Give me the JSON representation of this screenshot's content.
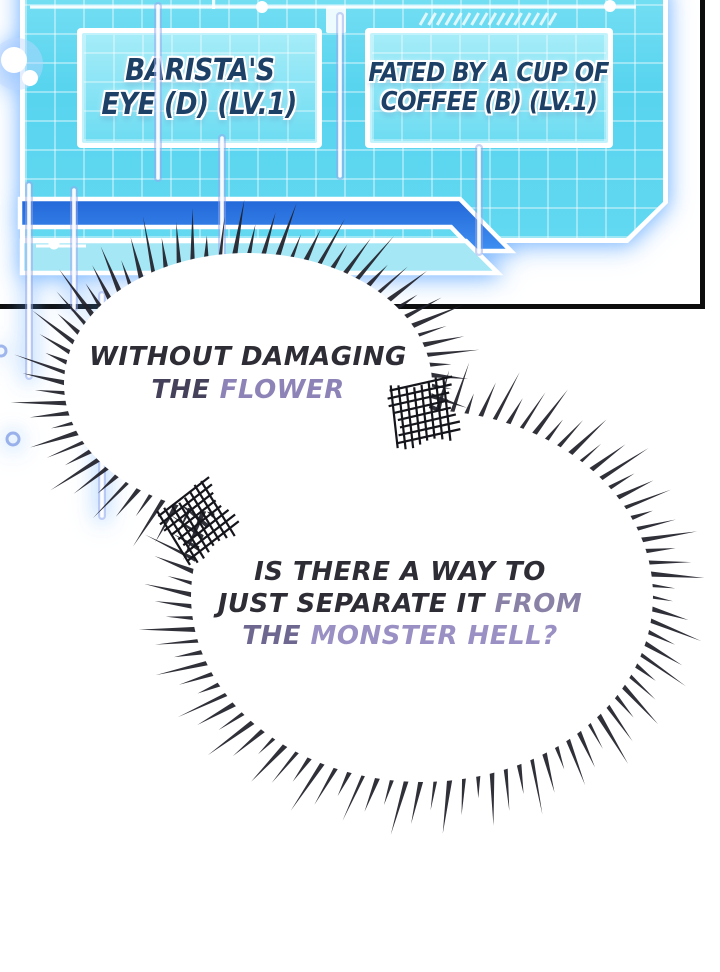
{
  "panel": {
    "skills": [
      {
        "line1": "BARISTA'S",
        "line2": "EYE (D) (LV.1)"
      },
      {
        "line1": "FATED BY A CUP OF",
        "line2": "COFFEE (B) (LV.1)"
      }
    ]
  },
  "bubbles": [
    {
      "name": "bubble-without-damaging",
      "lines": [
        {
          "segments": [
            {
              "text": "WITHOUT DAMAGING",
              "color": "#2e2c34"
            }
          ]
        },
        {
          "segments": [
            {
              "text": "THE ",
              "color": "#45415a"
            },
            {
              "text": "FLOWER",
              "color": "#8d83b6"
            }
          ]
        }
      ]
    },
    {
      "name": "bubble-is-there-a-way",
      "lines": [
        {
          "segments": [
            {
              "text": "IS THERE A WAY TO",
              "color": "#2e2c34"
            }
          ]
        },
        {
          "segments": [
            {
              "text": "JUST SEPARATE IT ",
              "color": "#2e2c34"
            },
            {
              "text": "FROM",
              "color": "#8a82a6"
            }
          ]
        },
        {
          "segments": [
            {
              "text": "THE ",
              "color": "#6e6890"
            },
            {
              "text": "MONSTER HELL?",
              "color": "#9a90c3"
            }
          ]
        }
      ]
    }
  ],
  "colors": {
    "panel_cyan": "#5cd6ef",
    "band_blue": "#2f7fe6",
    "skill_text_navy": "#1d4066",
    "bubble_purple": "#9a90c3",
    "frame_black": "#0d0d0d",
    "glow_blue": "#5ca6ff"
  }
}
